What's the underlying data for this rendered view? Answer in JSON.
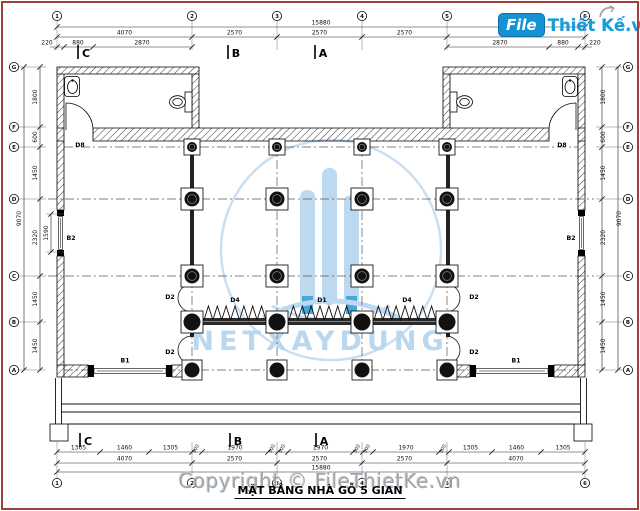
{
  "title": "MẶT BẰNG NHÀ GỖ 5 GIAN",
  "logo": {
    "file": "File",
    "brand": "Thiết Kế.vn"
  },
  "watermark": {
    "center_text": "NETXAYDUNG",
    "copyright": "Copyright © FileThietKe.vn"
  },
  "grid": {
    "cols": [
      "1",
      "2",
      "3",
      "4",
      "5",
      "6"
    ],
    "rows": [
      "G",
      "F",
      "E",
      "D",
      "C",
      "B",
      "A"
    ]
  },
  "sections": {
    "top": [
      "C",
      "B",
      "A"
    ],
    "bottom": [
      "C",
      "B",
      "A"
    ]
  },
  "dims": {
    "top_total": "15880",
    "top_bays": [
      "4070",
      "2570",
      "2570",
      "2570",
      "4070"
    ],
    "top_left_sub": [
      "220",
      "880",
      "2870"
    ],
    "top_right_sub": [
      "2870",
      "880",
      "220"
    ],
    "bottom_detail": [
      "1305",
      "1460",
      "1305",
      "300",
      "1970",
      "300",
      "300",
      "1970",
      "300",
      "300",
      "1970",
      "300",
      "1305",
      "1460",
      "1305"
    ],
    "bottom_bays": [
      "4070",
      "2570",
      "2570",
      "2570",
      "4070"
    ],
    "bottom_total": "15880",
    "left_total": "9070",
    "left_segs": [
      "1800",
      "600",
      "1450",
      "2320",
      "1450",
      "1450"
    ],
    "left_window": "1590",
    "right_total": "9070",
    "right_segs": [
      "1800",
      "600",
      "1450",
      "2320",
      "1450",
      "1450"
    ]
  },
  "labels": {
    "d8": "D8",
    "b2": "B2",
    "b1": "B1",
    "d2": "D2",
    "d4": "D4",
    "d1": "D1"
  },
  "colors": {
    "watermark_blue": "#b9d7ee",
    "logo_blue": "#1692d4",
    "frame_red": "#9c4040"
  }
}
